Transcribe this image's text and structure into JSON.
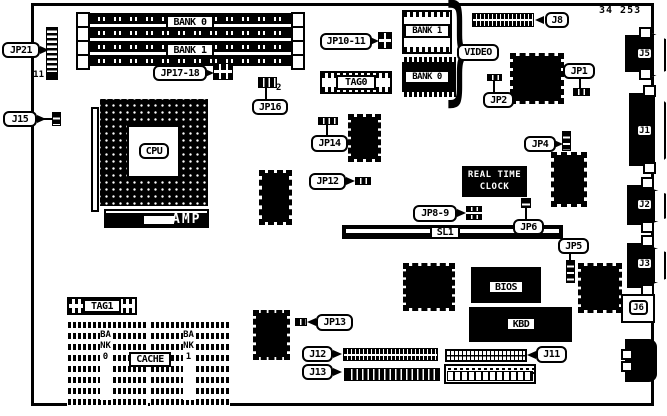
{
  "part_number": "34 253",
  "memory": {
    "bank0_label": "BANK 0",
    "bank1_label": "BANK 1"
  },
  "cpu": {
    "label": "CPU",
    "amp": "AMP"
  },
  "video": {
    "bank1": "BANK 1",
    "bank0": "BANK 0",
    "label": "VIDEO",
    "brace": "}"
  },
  "chips": {
    "tag0": "TAG0",
    "tag1": "TAG1",
    "rtc_line1": "REAL TIME",
    "rtc_line2": "CLOCK",
    "bios": "BIOS",
    "kbd": "KBD",
    "cache_label": "CACHE",
    "cache_bank0": "BANK0",
    "cache_bank1": "BANK1"
  },
  "slots": {
    "sl1": "SL1"
  },
  "jumpers": {
    "jp21": "JP21",
    "jp21_pin": "11",
    "jp17_18": "JP17-18",
    "jp16": "JP16",
    "jp16_pin": "2",
    "jp10_11": "JP10-11",
    "jp14": "JP14",
    "jp12": "JP12",
    "jp13": "JP13",
    "jp2": "JP2",
    "jp1": "JP1",
    "jp4": "JP4",
    "jp8_9": "JP8-9",
    "jp6": "JP6",
    "jp5": "JP5"
  },
  "connectors": {
    "j15": "J15",
    "j8": "J8",
    "j5": "J5",
    "j1": "J1",
    "j2": "J2",
    "j3": "J3",
    "j6": "J6",
    "j11": "J11",
    "j12": "J12",
    "j13": "J13"
  }
}
